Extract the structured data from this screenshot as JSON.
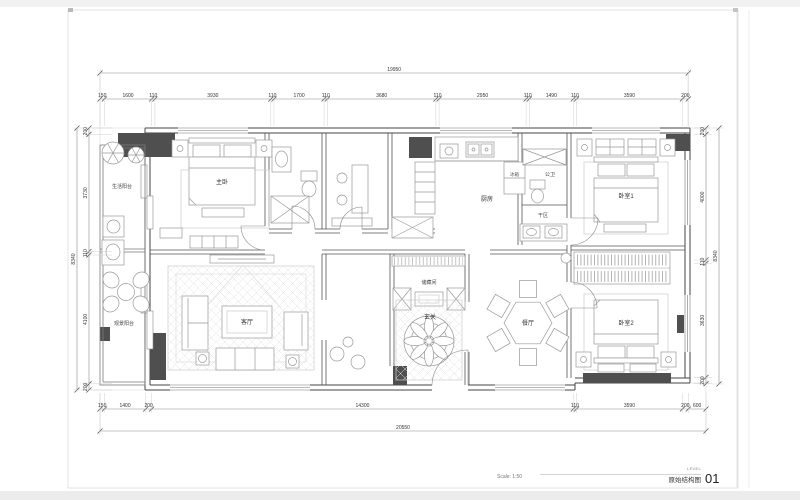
{
  "sheet": {
    "scale_label": "Scale: 1:50",
    "level_label": "LEVEL",
    "sheet_title": "原始结构图",
    "sheet_number": "01"
  },
  "rooms": {
    "life_balcony": "生活阳台",
    "master_bedroom": "主卧",
    "kitchen": "厨房",
    "fridge": "冰箱",
    "guest_bath": "公卫",
    "dry_area": "干区",
    "bedroom1": "卧室1",
    "view_balcony": "观景阳台",
    "living_room": "客厅",
    "storage": "储藏间",
    "foyer": "玄关",
    "dining_room": "餐厅",
    "bedroom2": "卧室2"
  },
  "dims": {
    "top_overall": "19950",
    "top_segments": [
      "150",
      "1600",
      "110",
      "3930",
      "110",
      "1700",
      "110",
      "3680",
      "110",
      "2950",
      "110",
      "1490",
      "110",
      "3590",
      "200"
    ],
    "bottom_segments": [
      "150",
      "1400",
      "200",
      "14300",
      "110",
      "3590",
      "200",
      "600"
    ],
    "bottom_overall": "20550",
    "left_overall": "8340",
    "left_segments": [
      "200",
      "3730",
      "110",
      "4100",
      "200"
    ],
    "right_overall": "8340",
    "right_segments": [
      "200",
      "4000",
      "110",
      "3630",
      "200"
    ]
  }
}
